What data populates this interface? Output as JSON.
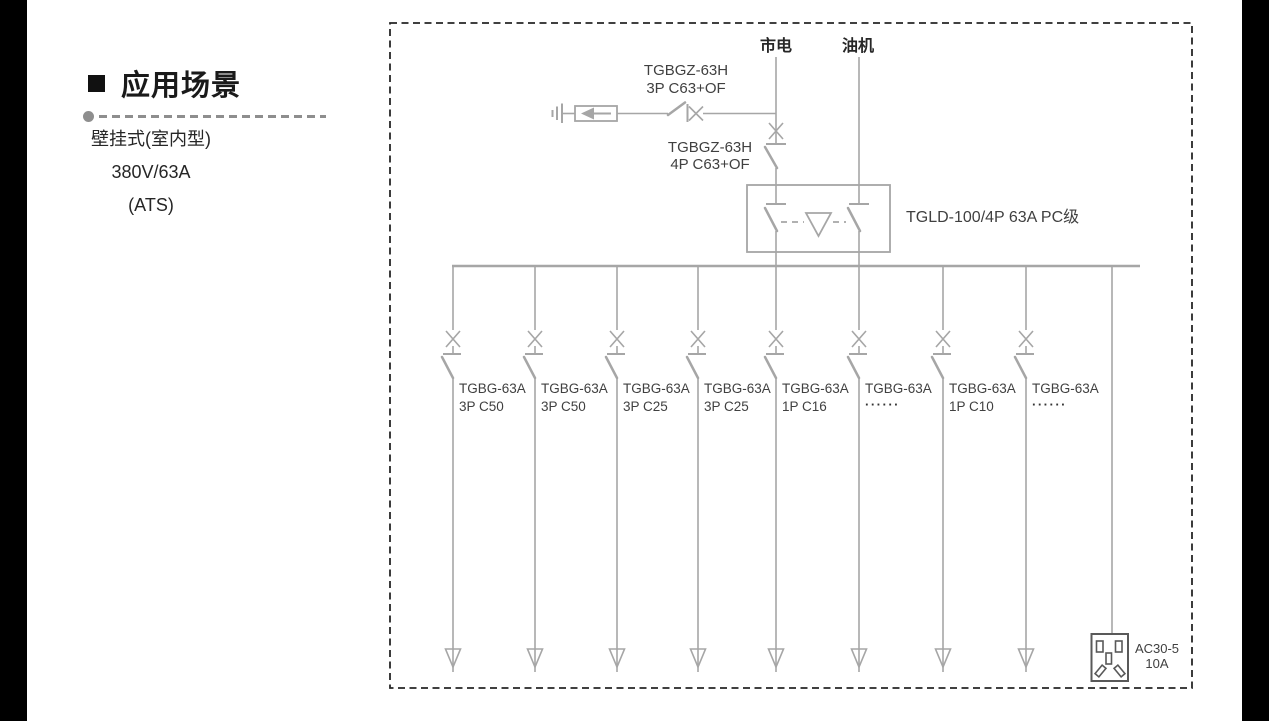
{
  "left_panel": {
    "title": "应用场景",
    "lines": [
      "壁挂式(室内型)",
      "380V/63A",
      "(ATS)"
    ]
  },
  "diagram": {
    "source_mains": "市电",
    "source_generator": "油机",
    "breaker_3p": {
      "name": "TGBGZ-63H",
      "spec": "3P C63+OF"
    },
    "breaker_4p": {
      "name": "TGBGZ-63H",
      "spec": "4P C63+OF"
    },
    "ats_label": "TGLD-100/4P 63A PC级",
    "branches": [
      {
        "name": "TGBG-63A",
        "spec": "3P C50"
      },
      {
        "name": "TGBG-63A",
        "spec": "3P C50"
      },
      {
        "name": "TGBG-63A",
        "spec": "3P C25"
      },
      {
        "name": "TGBG-63A",
        "spec": "3P C25"
      },
      {
        "name": "TGBG-63A",
        "spec": "1P C16"
      },
      {
        "name": "TGBG-63A",
        "spec": "······"
      },
      {
        "name": "TGBG-63A",
        "spec": "1P C10"
      },
      {
        "name": "TGBG-63A",
        "spec": "······"
      }
    ],
    "socket": {
      "model": "AC30-5",
      "rating": "10A"
    }
  },
  "colors": {
    "diagram_line": "#a6a6a6",
    "diagram_text": "#404040",
    "dashed_border": "#262626",
    "socket_outline": "#595959",
    "edge_bar": "#000000"
  }
}
